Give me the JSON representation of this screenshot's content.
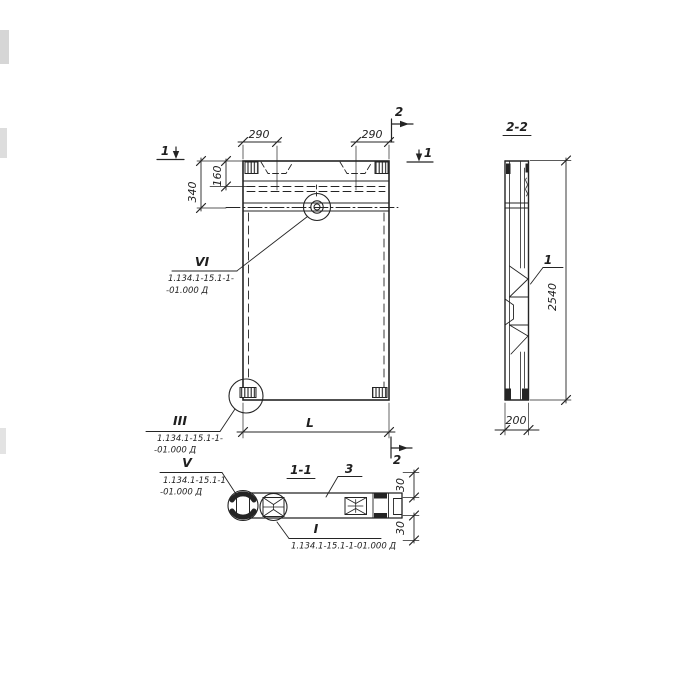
{
  "colors": {
    "ink": "#242424",
    "paper": "#ffffff"
  },
  "elevation": {
    "dim_290_left": "290",
    "dim_290_right": "290",
    "dim_340": "340",
    "dim_160": "160",
    "dim_L": "L",
    "mark_1_left": "1",
    "mark_1_right": "1",
    "mark_2_top": "2",
    "mark_2_bottom": "2",
    "callout_vi": {
      "num": "VI",
      "line1": "1.134.1-15.1-1-",
      "line2": "-01.000 Д"
    },
    "callout_iii": {
      "num": "III",
      "line1": "1.134.1-15.1-1-",
      "line2": "-01.000 Д"
    }
  },
  "section_2_2": {
    "title": "2-2",
    "dim_2540": "2540",
    "dim_200": "200",
    "part_1": "1"
  },
  "section_1_1": {
    "title": "1-1",
    "part_3": "3",
    "dim_30_top": "30",
    "dim_30_bottom": "30",
    "callout_v": {
      "num": "V",
      "line1": "1.134.1-15.1-1",
      "line2": "-01.000 Д"
    },
    "callout_i": {
      "num": "I",
      "line1": "1.134.1-15.1-1-01.000 Д"
    }
  }
}
